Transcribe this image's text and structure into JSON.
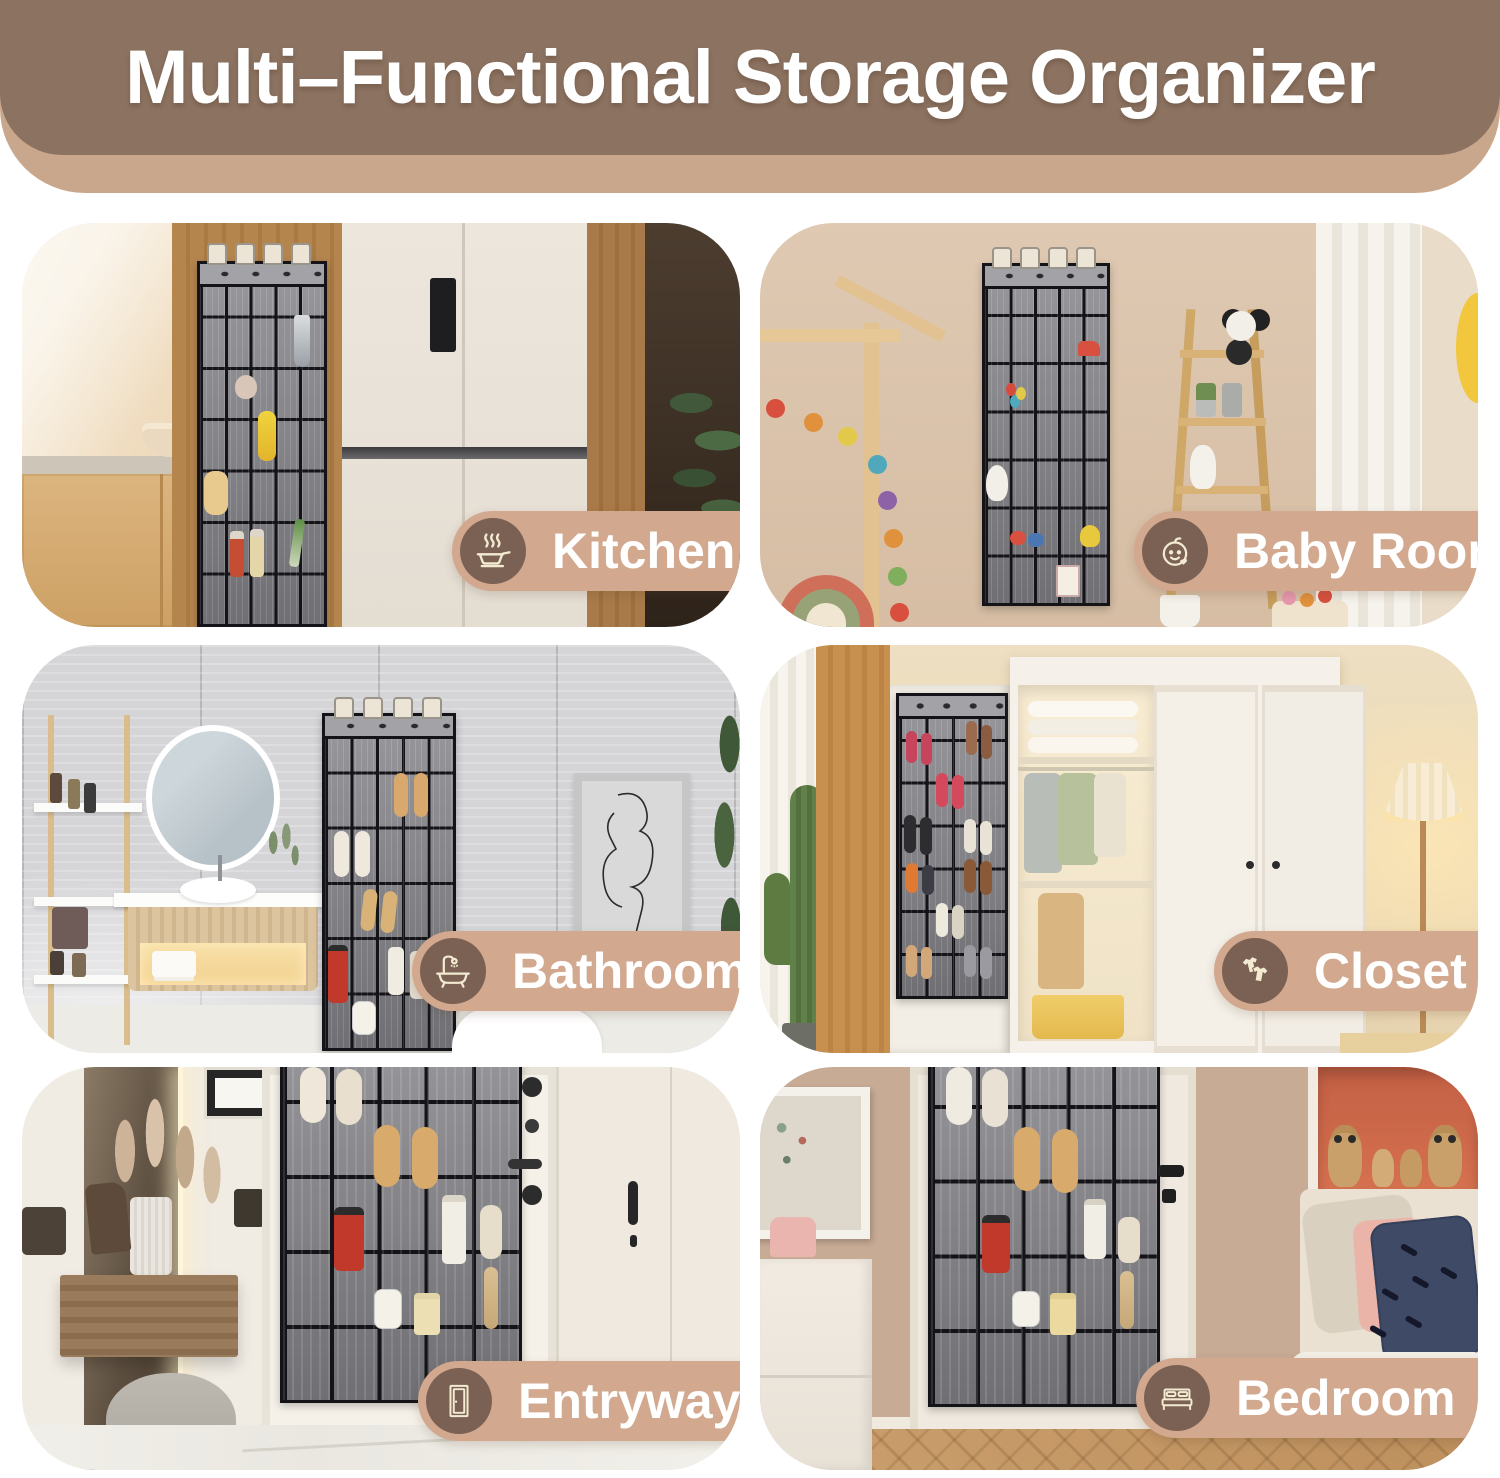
{
  "banner": {
    "title": "Multi–Functional Storage Organizer"
  },
  "panels": [
    {
      "id": "kitchen",
      "label": "Kitchen",
      "icon": "cooking-pan-icon"
    },
    {
      "id": "baby-room",
      "label": "Baby Room",
      "icon": "baby-face-icon"
    },
    {
      "id": "bathroom",
      "label": "Bathroom",
      "icon": "bathtub-icon"
    },
    {
      "id": "closet",
      "label": "Closet",
      "icon": "shirts-icon"
    },
    {
      "id": "entryway",
      "label": "Entryway",
      "icon": "door-icon"
    },
    {
      "id": "bedroom",
      "label": "Bedroom",
      "icon": "bed-icon"
    }
  ],
  "colors": {
    "banner_brown": "#8c7260",
    "banner_tan": "#c9a78c",
    "pill_tan": "#d2a88e",
    "pill_circle_brown": "#7b6153",
    "icon_cream": "#f3ead2",
    "label_text": "#ffffff",
    "organizer_frame": "#141418",
    "organizer_pocket_gray": "#8a8a8e"
  }
}
